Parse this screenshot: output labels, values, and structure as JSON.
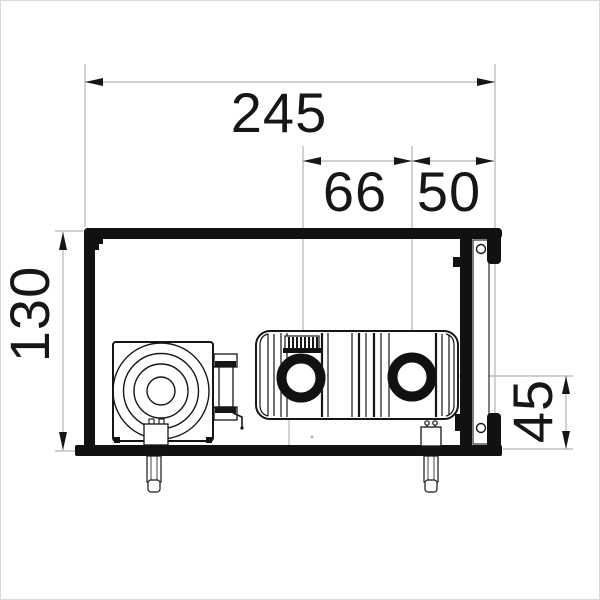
{
  "drawing": {
    "type": "technical-dimension-drawing",
    "subject": "convector cross-section with fan unit and two heat-exchanger pipes",
    "dimensions": {
      "overall_width": "245",
      "pipe_spacing": "66",
      "pipe_to_edge": "50",
      "overall_height": "130",
      "pipe_center_height": "45"
    },
    "colors": {
      "object_line": "#161616",
      "dimension_line": "#b5b5b5",
      "background": "#ffffff"
    }
  }
}
